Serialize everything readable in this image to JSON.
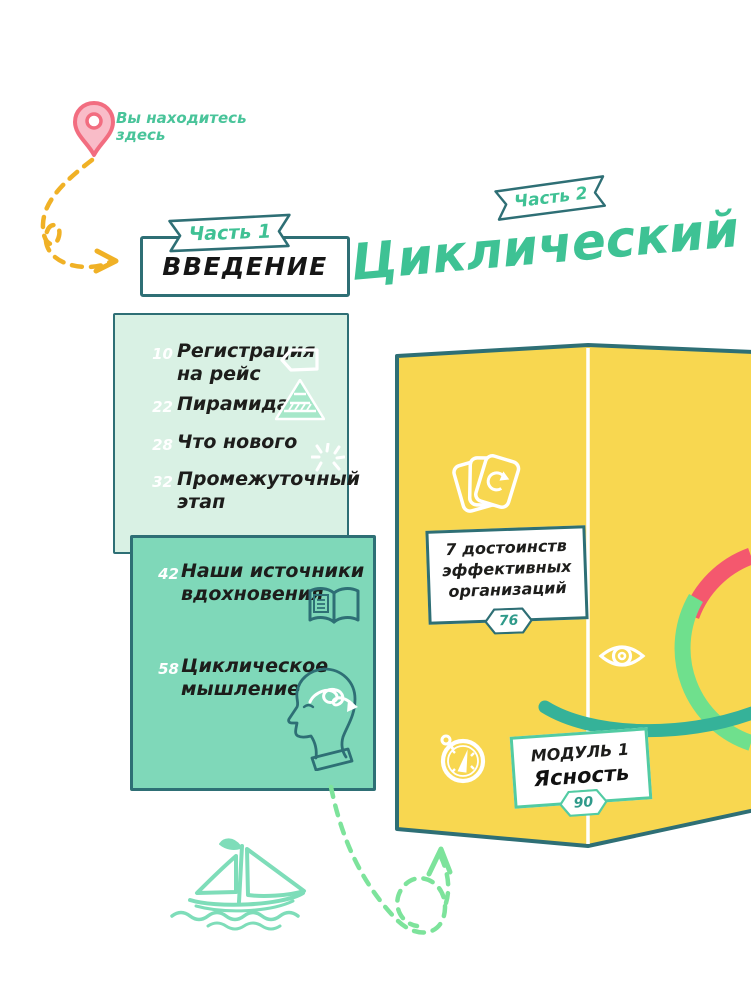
{
  "palette": {
    "teal_dark": "#2e6f75",
    "green_text": "#3ec294",
    "mint_light": "#d9f1e4",
    "mint_medium": "#7fd8b9",
    "yellow_map": "#f8d750",
    "pink_arc": "#f4586e",
    "light_green_arc": "#6fe08d",
    "teal_brush": "#35b299",
    "yellow_dash": "#f0b126",
    "green_dash": "#7de39b",
    "pin_pink": "#f26d80",
    "ink": "#1d1d1b"
  },
  "you_are_here": "Вы находитесь\nздесь",
  "part1": {
    "banner": "Часть 1",
    "title": "ВВЕДЕНИЕ"
  },
  "part2": {
    "banner": "Часть 2",
    "title": "Циклический"
  },
  "intro": {
    "items": [
      {
        "page": "10",
        "label": "Регистрация\nна рейс",
        "icon": "luggage-tag"
      },
      {
        "page": "22",
        "label": "Пирамида",
        "icon": "pyramid"
      },
      {
        "page": "28",
        "label": "Что нового",
        "icon": "sparkle"
      },
      {
        "page": "32",
        "label": "Промежуточный\nэтап",
        "icon": ""
      }
    ]
  },
  "sources": {
    "items": [
      {
        "page": "42",
        "label": "Наши источники\nвдохновения",
        "icon": "open-book"
      },
      {
        "page": "58",
        "label": "Циклическое\nмышление",
        "icon": "head-spiral"
      }
    ]
  },
  "map": {
    "advantages": {
      "text": "7 достоинств\nэффективных\nорганизаций",
      "page": "76"
    },
    "module1": {
      "title": "МОДУЛЬ 1",
      "subtitle": "Ясность",
      "page": "90"
    }
  }
}
